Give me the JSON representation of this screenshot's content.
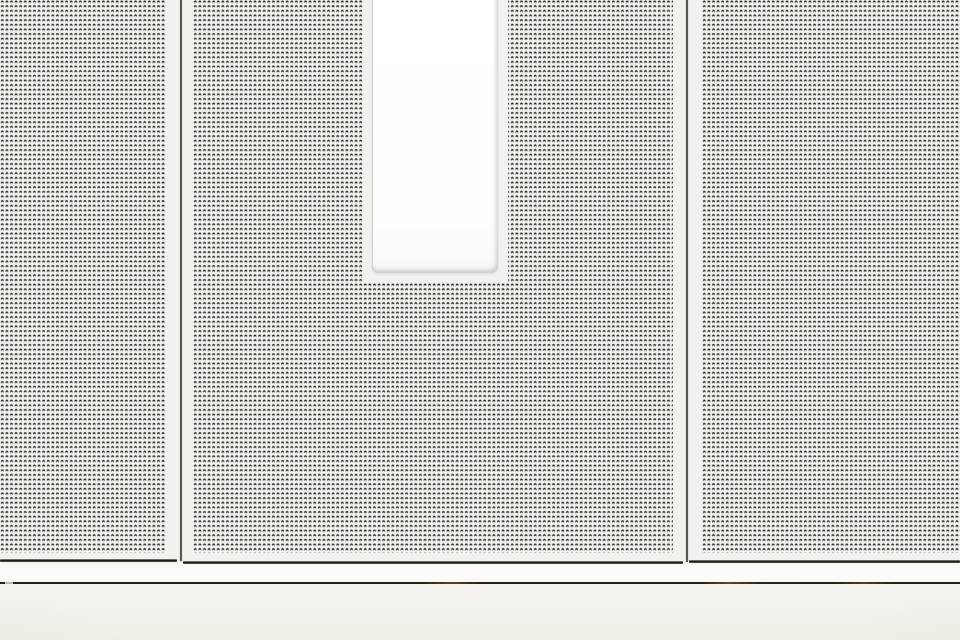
{
  "meta": {
    "type": "photograph",
    "subject": "Close-up of white micro-perforated metal wall panels with a bright recessed rectangular light opening, two dark vertical panel seams, and a plain fascia band with a shadow reveal line along the bottom",
    "visible_text": "none"
  },
  "colors": {
    "panel_base": "#f3f1ee",
    "perforation_dot": "#231f19",
    "seam_line": "#17140f",
    "panel_edge_line": "#211e18",
    "light_opening": "#fefefe",
    "fascia_band": "#fdfcfa",
    "reveal_line": "#282218",
    "base_band": "#f4f1ec"
  },
  "elements": {
    "panel_count": 3,
    "panels": [
      {
        "name": "left perforated panel"
      },
      {
        "name": "middle perforated panel containing the light opening"
      },
      {
        "name": "right perforated panel"
      }
    ],
    "light_opening": {
      "shape": "vertical rectangle",
      "state": "bright white, recessed, rounded bottom corners"
    },
    "seam_count": 2,
    "bottom_bands": [
      "white fascia strip",
      "dark shadow reveal line with warm metallic glints",
      "plain off-white base band"
    ]
  }
}
